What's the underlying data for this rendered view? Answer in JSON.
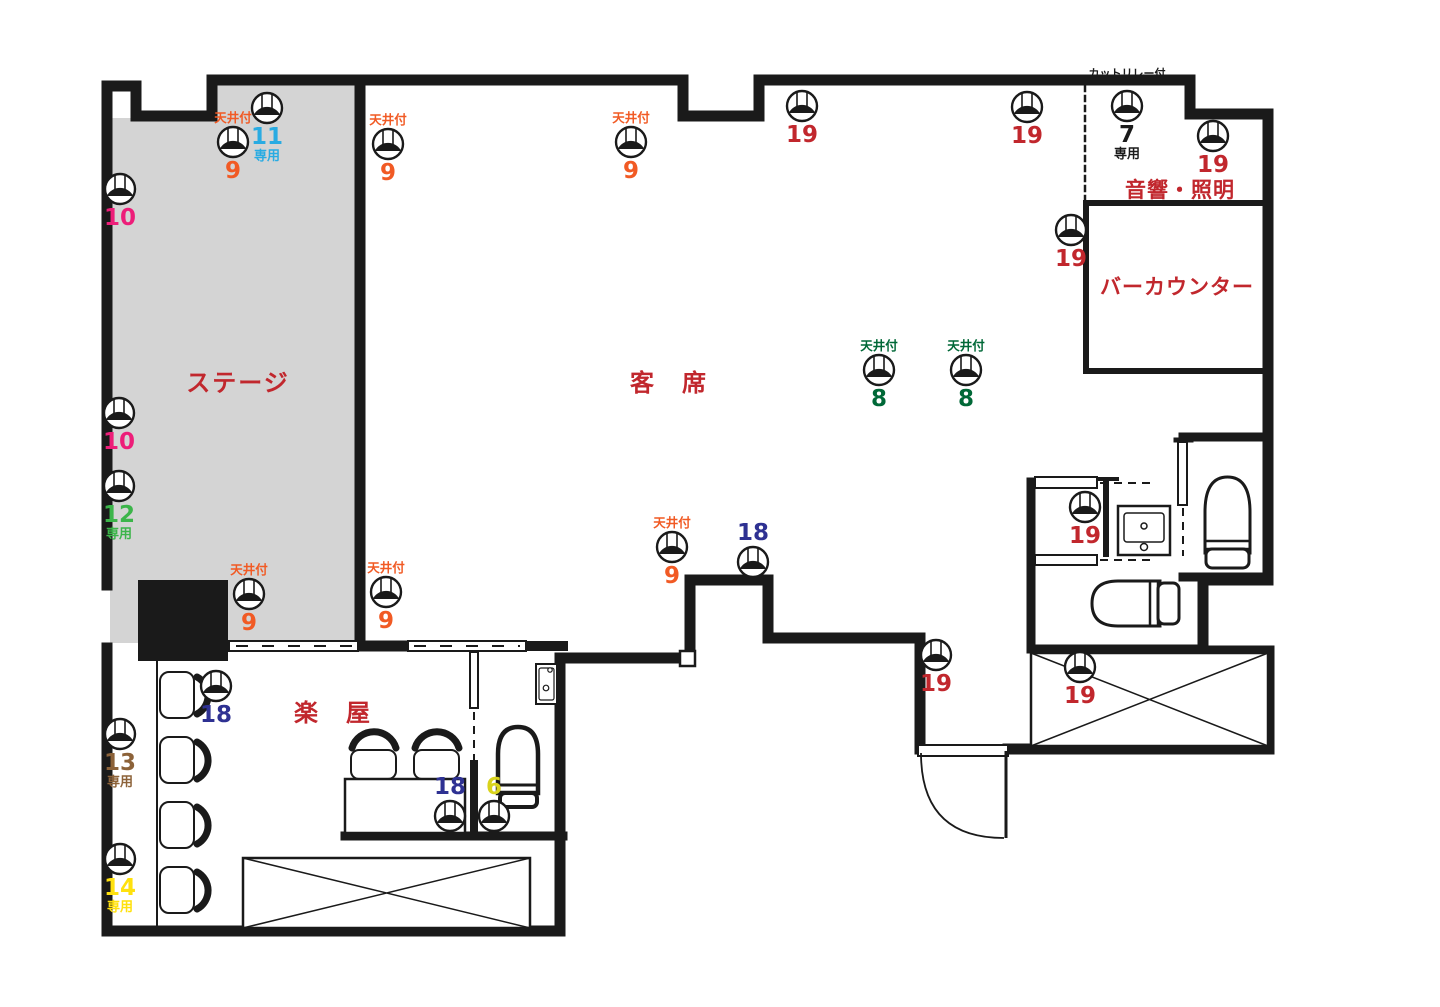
{
  "palette": {
    "orange": "#F15A24",
    "red": "#C1272D",
    "pink": "#ED1E79",
    "skyblue": "#29ABE2",
    "green": "#3CB54A",
    "darkgreen": "#006837",
    "navy": "#2E3192",
    "brown": "#8C6239",
    "yellow": "#FFE10E",
    "olive": "#D9D31C",
    "black": "#1A1A1A",
    "wall": "#1A1A1A",
    "stage_fill": "#D4D4D4"
  },
  "terms": {
    "ceiling_label": "天井付",
    "exclusive_label": "専用"
  },
  "rooms": {
    "stage": {
      "label": "ステージ"
    },
    "seats": {
      "label": "客　席"
    },
    "gakuya": {
      "label": "楽　屋"
    },
    "sound": {
      "label": "音響・照明"
    },
    "bar": {
      "label": "バーカウンター"
    }
  },
  "annotations": {
    "cut_relay": {
      "label": "カットリレー付"
    }
  },
  "fixtures": [
    {
      "x": 267,
      "y": 108,
      "num": "11",
      "color": "skyblue",
      "senyou": true
    },
    {
      "x": 233,
      "y": 142,
      "num": "9",
      "color": "orange",
      "ceiling": true
    },
    {
      "x": 120,
      "y": 189,
      "num": "10",
      "color": "pink"
    },
    {
      "x": 119,
      "y": 413,
      "num": "10",
      "color": "pink"
    },
    {
      "x": 119,
      "y": 486,
      "num": "12",
      "color": "green",
      "senyou": true
    },
    {
      "x": 249,
      "y": 594,
      "num": "9",
      "color": "orange",
      "ceiling": true
    },
    {
      "x": 386,
      "y": 592,
      "num": "9",
      "color": "orange",
      "ceiling": true
    },
    {
      "x": 388,
      "y": 144,
      "num": "9",
      "color": "orange",
      "ceiling": true
    },
    {
      "x": 631,
      "y": 142,
      "num": "9",
      "color": "orange",
      "ceiling": true
    },
    {
      "x": 802,
      "y": 106,
      "num": "19",
      "color": "red"
    },
    {
      "x": 1027,
      "y": 107,
      "num": "19",
      "color": "red"
    },
    {
      "x": 1127,
      "y": 106,
      "num": "7",
      "color": "black",
      "senyou": true
    },
    {
      "x": 1213,
      "y": 136,
      "num": "19",
      "color": "red"
    },
    {
      "x": 1071,
      "y": 230,
      "num": "19",
      "color": "red"
    },
    {
      "x": 879,
      "y": 370,
      "num": "8",
      "color": "darkgreen",
      "ceiling": true
    },
    {
      "x": 966,
      "y": 370,
      "num": "8",
      "color": "darkgreen",
      "ceiling": true
    },
    {
      "x": 672,
      "y": 547,
      "num": "9",
      "color": "orange",
      "ceiling": true
    },
    {
      "x": 753,
      "y": 562,
      "num": "18",
      "color": "navy",
      "label_above": true
    },
    {
      "x": 936,
      "y": 655,
      "num": "19",
      "color": "red"
    },
    {
      "x": 1085,
      "y": 507,
      "num": "19",
      "color": "red"
    },
    {
      "x": 1080,
      "y": 667,
      "num": "19",
      "color": "red"
    },
    {
      "x": 216,
      "y": 686,
      "num": "18",
      "color": "navy"
    },
    {
      "x": 120,
      "y": 734,
      "num": "13",
      "color": "brown",
      "senyou": true
    },
    {
      "x": 120,
      "y": 859,
      "num": "14",
      "color": "yellow",
      "senyou": true
    },
    {
      "x": 450,
      "y": 816,
      "num": "18",
      "color": "navy",
      "label_above": true
    },
    {
      "x": 494,
      "y": 816,
      "num": "6",
      "color": "olive",
      "label_above": true
    }
  ]
}
